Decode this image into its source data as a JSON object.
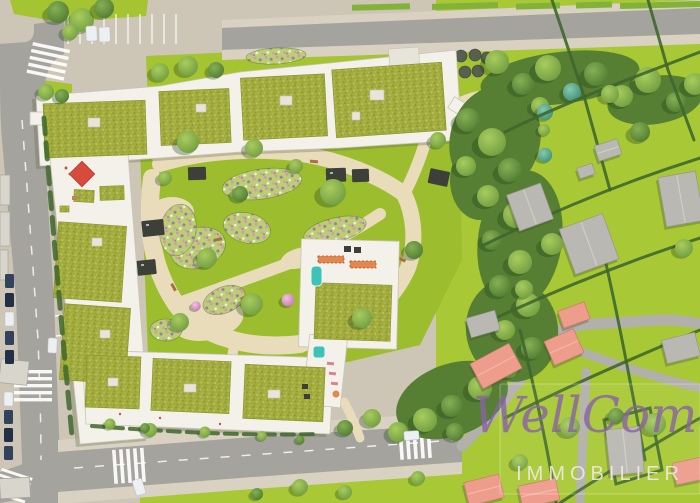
{
  "watermark": {
    "script_text": "WellCome",
    "caps_text": "IMMOBILIER"
  },
  "scene": {
    "type": "aerial-3d-masterplan-render",
    "description": "Bird's-eye rendering of a residential development: perimeter apartment blocks with green sedum roofs and rooftop terraces around a landscaped courtyard with cream paths and flower beds, bordered by streets with crosswalks and parked cars, a dense tree belt, and neighbouring hedged parcels with salmon- and grey-roofed houses.",
    "features": [
      "streets with ladder crosswalks and dashed lane lines",
      "parking bays with cars",
      "green sedum roofs with rooftop access boxes",
      "rooftop terrace with red canopy",
      "two small turquoise rooftop pools",
      "courtyard garden with cream paths, flower beds, pergolas and benches",
      "playground with pink play surface",
      "rows of dark clipped shrub domes",
      "dense tree belt",
      "suburban parcels divided by hedges with salmon and grey roofed houses",
      "watermark plate"
    ]
  },
  "palette": {
    "pavement": "#cdc5b6",
    "sidewalk": "#d9d1c1",
    "path_cream": "#e9dcba",
    "asphalt": "#a5a39e",
    "asphalt_lane": "#b2b0aa",
    "lawn": "#a4c431",
    "field": "#a8c935",
    "court_lawn": "#9cbe2e",
    "median_green": "#83b239",
    "forest_base": "#567f33",
    "hedge": "#3f672c",
    "green_roof": "#a3ac3f",
    "green_roof_dark": "#8c962f",
    "green_roof_light": "#bcc45c",
    "building_white": "#f3f1e9",
    "building_edge": "#c9c5b6",
    "building_shadow": "#5a6340",
    "roof_access": "#e7e4da",
    "existing_roof": "#d8d5cc",
    "salmon_roof": "#ee9c8c",
    "salmon_ridge": "#f6b5a7",
    "salmon_edge": "#c97b6e",
    "gray_roof": "#bab8b2",
    "gray_roof_light": "#d0cec8",
    "gray_roof_edge": "#979590",
    "flower_base": "#bad06e",
    "flower_pink": "#dd8fc4",
    "flower_purple": "#9f74bd",
    "flower_white": "#f2eef6",
    "teal_shrub": "#6aa892",
    "pale_lawn": "#c6dd8e",
    "pool_teal": "#3ec3b6",
    "pergola_dark": "#3c4038",
    "dark_unit": "#3a3f38",
    "shrub_dome": "#57604f",
    "red_canopy": "#d84a3c",
    "orange_awning": "#e0884e",
    "lounger_pink": "#d9818f",
    "bench_brown": "#a5713f",
    "car_navy": "#32415c",
    "car_dark": "#222f44",
    "car_white": "#edf0f2",
    "marking_white": "#ffffff",
    "tree_dark_hi": "#86b054",
    "tree_dark_lo": "#4e7a30",
    "tree_mid_hi": "#a8cc5e",
    "tree_mid_lo": "#6f9c3f",
    "tree_teal_hi": "#85c9ab",
    "tree_teal_lo": "#3f8d77",
    "blossom_hi": "#f0c3e0",
    "blossom_lo": "#c776ae",
    "watermark_purple": "#8a63a6",
    "watermark_white": "#efe9e2"
  }
}
